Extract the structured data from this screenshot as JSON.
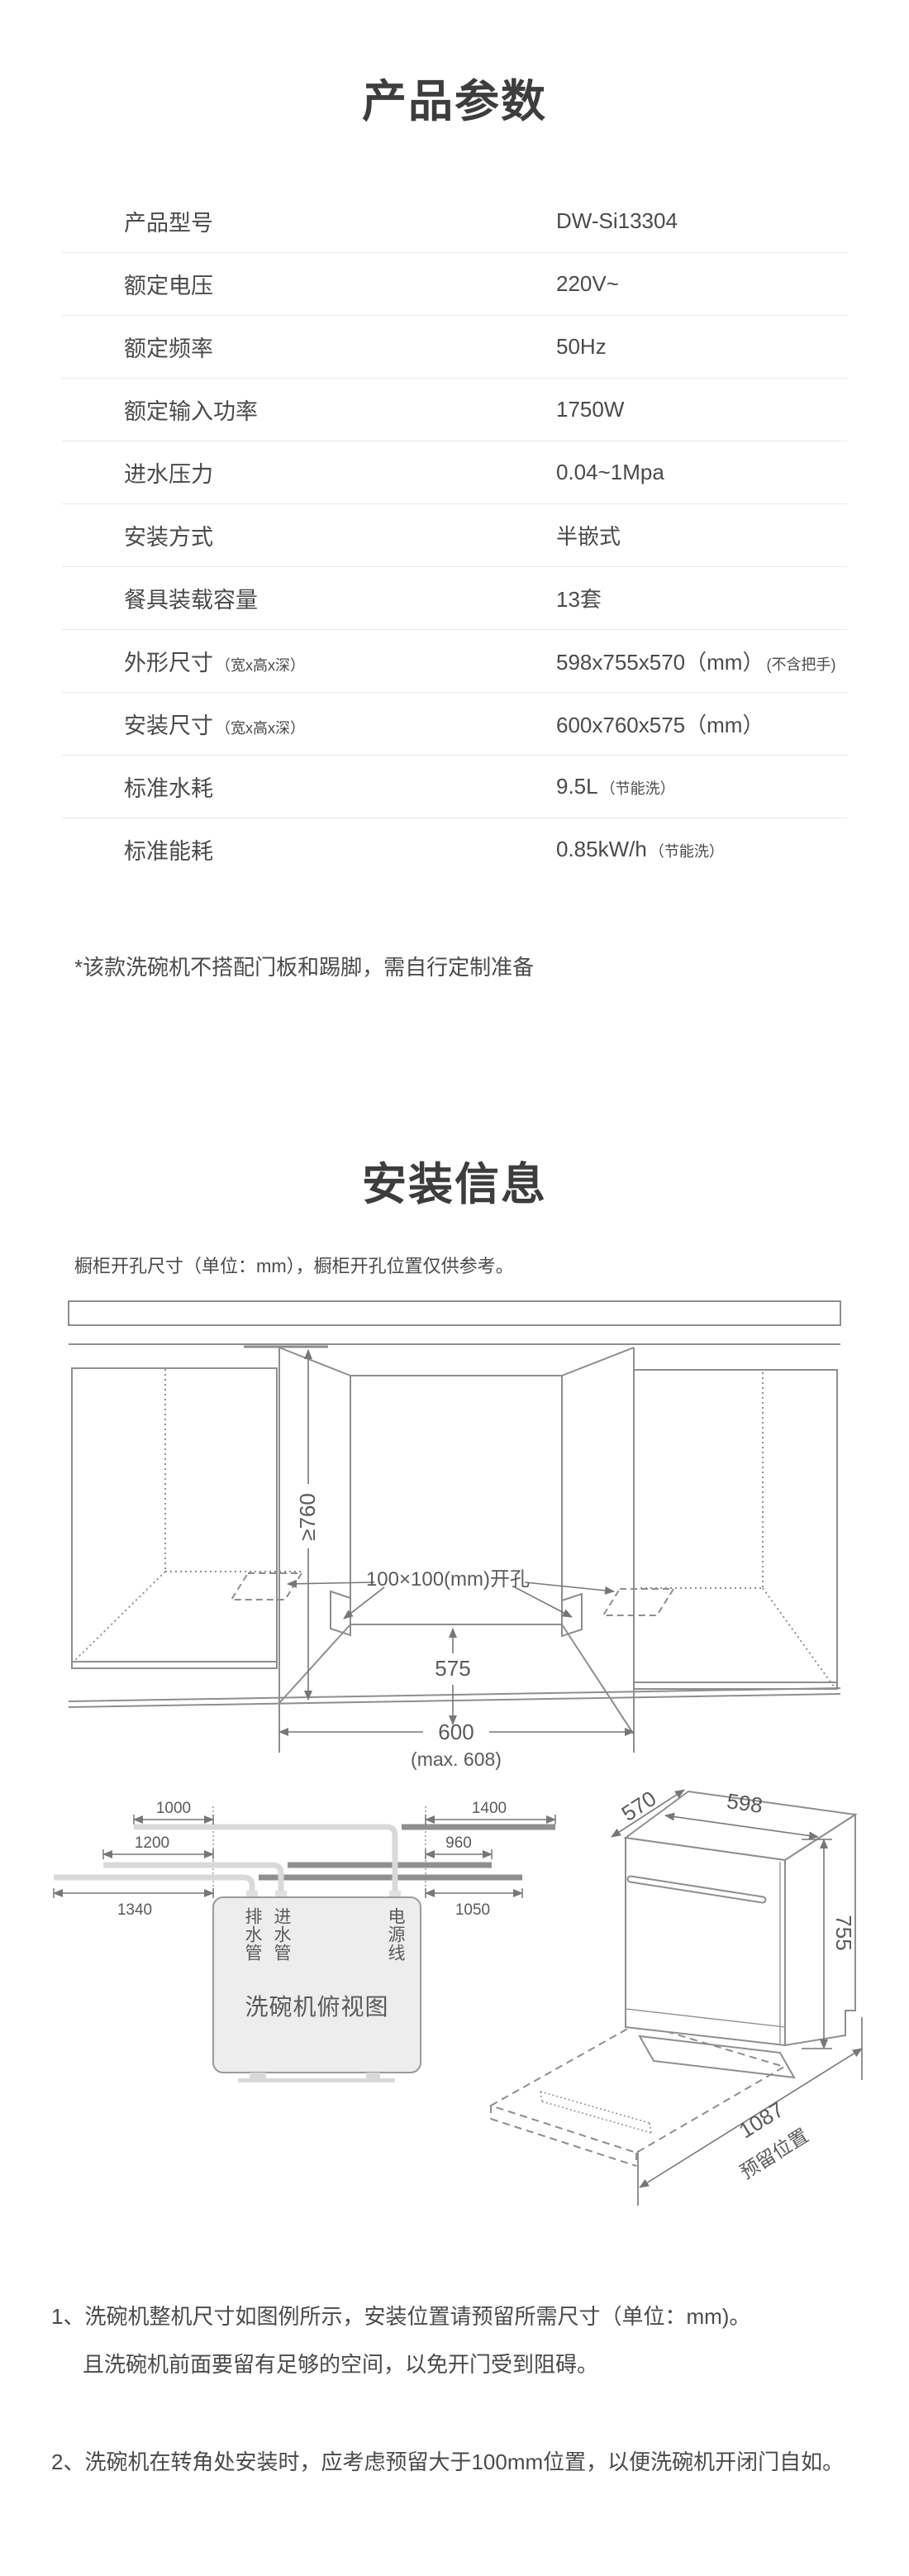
{
  "colors": {
    "background": "#ffffff",
    "title_text": "#3d3d3d",
    "body_text": "#4a4a4a",
    "divider": "#e9e9e9",
    "line_art": "#8e8e8e",
    "dim_line": "#777777",
    "pipe_light": "#d9d9d9",
    "pipe_dark": "#8f8f8f",
    "box_fill": "#ededed"
  },
  "section1": {
    "title": "产品参数",
    "rows": [
      {
        "label": "产品型号",
        "label_note": "",
        "value": "DW-Si13304",
        "value_note": ""
      },
      {
        "label": "额定电压",
        "label_note": "",
        "value": "220V~",
        "value_note": ""
      },
      {
        "label": "额定频率",
        "label_note": "",
        "value": "50Hz",
        "value_note": ""
      },
      {
        "label": "额定输入功率",
        "label_note": "",
        "value": "1750W",
        "value_note": ""
      },
      {
        "label": "进水压力",
        "label_note": "",
        "value": "0.04~1Mpa",
        "value_note": ""
      },
      {
        "label": "安装方式",
        "label_note": "",
        "value": "半嵌式",
        "value_note": ""
      },
      {
        "label": "餐具装载容量",
        "label_note": "",
        "value": "13套",
        "value_note": ""
      },
      {
        "label": "外形尺寸",
        "label_note": "（宽x高x深）",
        "value": "598x755x570（mm）",
        "value_note": "(不含把手)"
      },
      {
        "label": "安装尺寸",
        "label_note": "（宽x高x深）",
        "value": "600x760x575（mm）",
        "value_note": ""
      },
      {
        "label": "标准水耗",
        "label_note": "",
        "value": "9.5L",
        "value_note": "（节能洗）"
      },
      {
        "label": "标准能耗",
        "label_note": "",
        "value": "0.85kW/h",
        "value_note": "（节能洗）"
      }
    ],
    "footnote": "*该款洗碗机不搭配门板和踢脚，需自行定制准备"
  },
  "section2": {
    "title": "安装信息",
    "subtitle": "橱柜开孔尺寸（单位：mm），橱柜开孔位置仅供参考。",
    "cutout": {
      "height_dim": "≥760",
      "hole_label": "100×100(mm)开孔",
      "depth_dim": "575",
      "width_dim": "600",
      "width_max": "(max. 608)"
    },
    "topview": {
      "dim_1000": "1000",
      "dim_1200": "1200",
      "dim_1340": "1340",
      "dim_1400": "1400",
      "dim_960": "960",
      "dim_1050": "1050",
      "drain_label": "排水管",
      "inlet_label": "进水管",
      "power_label": "电源线",
      "caption": "洗碗机俯视图"
    },
    "machine": {
      "depth_dim": "570",
      "width_dim": "598",
      "height_dim": "755",
      "reserve_dim": "1087",
      "reserve_label": "预留位置"
    },
    "notes": [
      "1、洗碗机整机尺寸如图例所示，安装位置请预留所需尺寸（单位：mm)。",
      "且洗碗机前面要留有足够的空间，以免开门受到阻碍。",
      "2、洗碗机在转角处安装时，应考虑预留大于100mm位置，以便洗碗机开闭门自如。"
    ]
  }
}
